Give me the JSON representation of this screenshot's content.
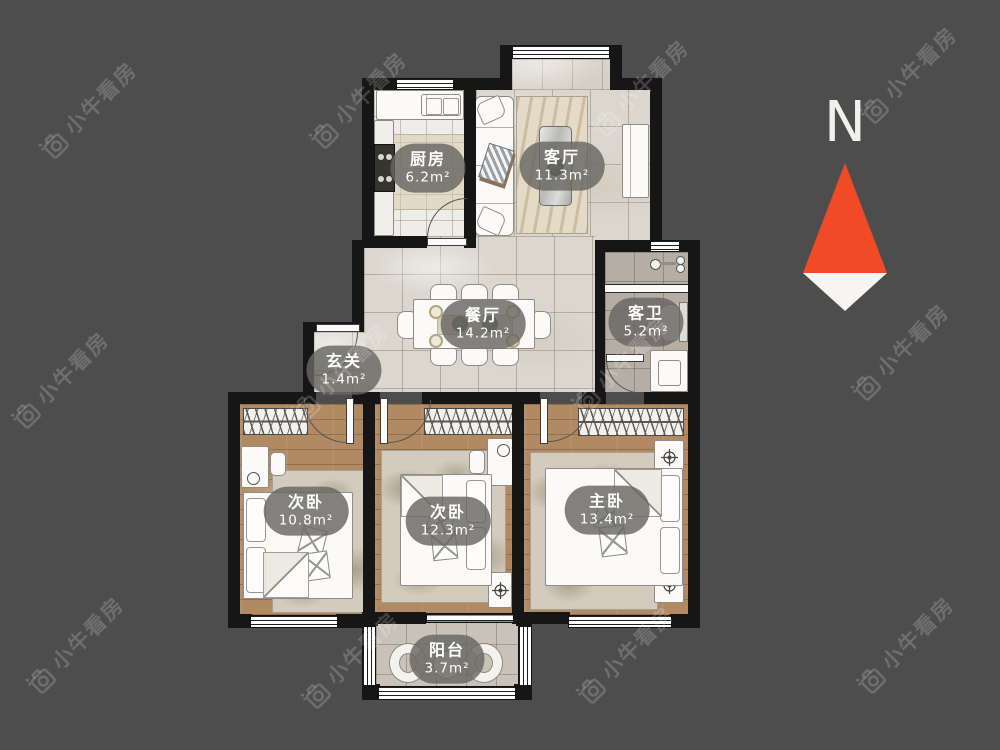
{
  "watermark": {
    "text": "小牛看房"
  },
  "compass": {
    "label": "N"
  },
  "rooms": {
    "kitchen": {
      "name": "厨房",
      "area": "6.2m²"
    },
    "living": {
      "name": "客厅",
      "area": "11.3m²"
    },
    "dining": {
      "name": "餐厅",
      "area": "14.2m²"
    },
    "bath": {
      "name": "客卫",
      "area": "5.2m²"
    },
    "entry": {
      "name": "玄关",
      "area": "1.4m²"
    },
    "bedroom_left": {
      "name": "次卧",
      "area": "10.8m²"
    },
    "bedroom_mid": {
      "name": "次卧",
      "area": "12.3m²"
    },
    "bedroom_master": {
      "name": "主卧",
      "area": "13.4m²"
    },
    "balcony": {
      "name": "阳台",
      "area": "3.7m²"
    }
  },
  "colors": {
    "background": "#4d4d4d",
    "wall": "#161616",
    "compass_red": "#f04b26",
    "compass_white": "#f7f5f2",
    "label_pill": "rgba(104,102,97,0.82)"
  }
}
